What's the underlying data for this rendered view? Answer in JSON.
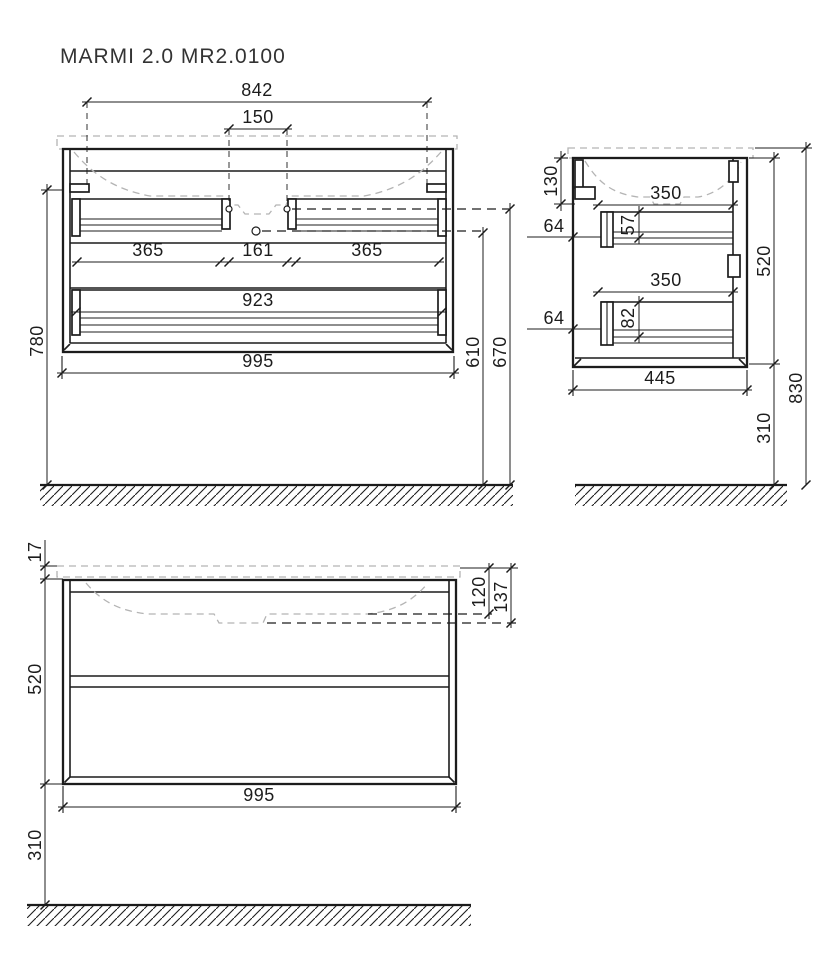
{
  "title": "MARMI 2.0 MR2.0100",
  "front": {
    "dim_top_width": "842",
    "dim_faucet_spacing": "150",
    "dim_left_drawer": "365",
    "dim_center_gap": "161",
    "dim_right_drawer": "365",
    "dim_bottom_drawer": "923",
    "dim_overall_width": "995",
    "dim_mount_height": "780",
    "dim_ref_inner": "610",
    "dim_ref_outer": "670"
  },
  "side": {
    "dim_top_section": "130",
    "dim_drawer_depth_top": "350",
    "dim_front_top": "57",
    "dim_gap_top": "64",
    "dim_drawer_depth_bottom": "350",
    "dim_front_bottom": "82",
    "dim_gap_bottom": "64",
    "dim_depth": "445",
    "dim_height": "520",
    "dim_overall_height": "830",
    "dim_floor_gap": "310"
  },
  "back": {
    "dim_top_thickness": "17",
    "dim_height": "520",
    "dim_floor_gap": "310",
    "dim_basin_ref_near": "120",
    "dim_basin_ref_far": "137",
    "dim_overall_width": "995"
  }
}
